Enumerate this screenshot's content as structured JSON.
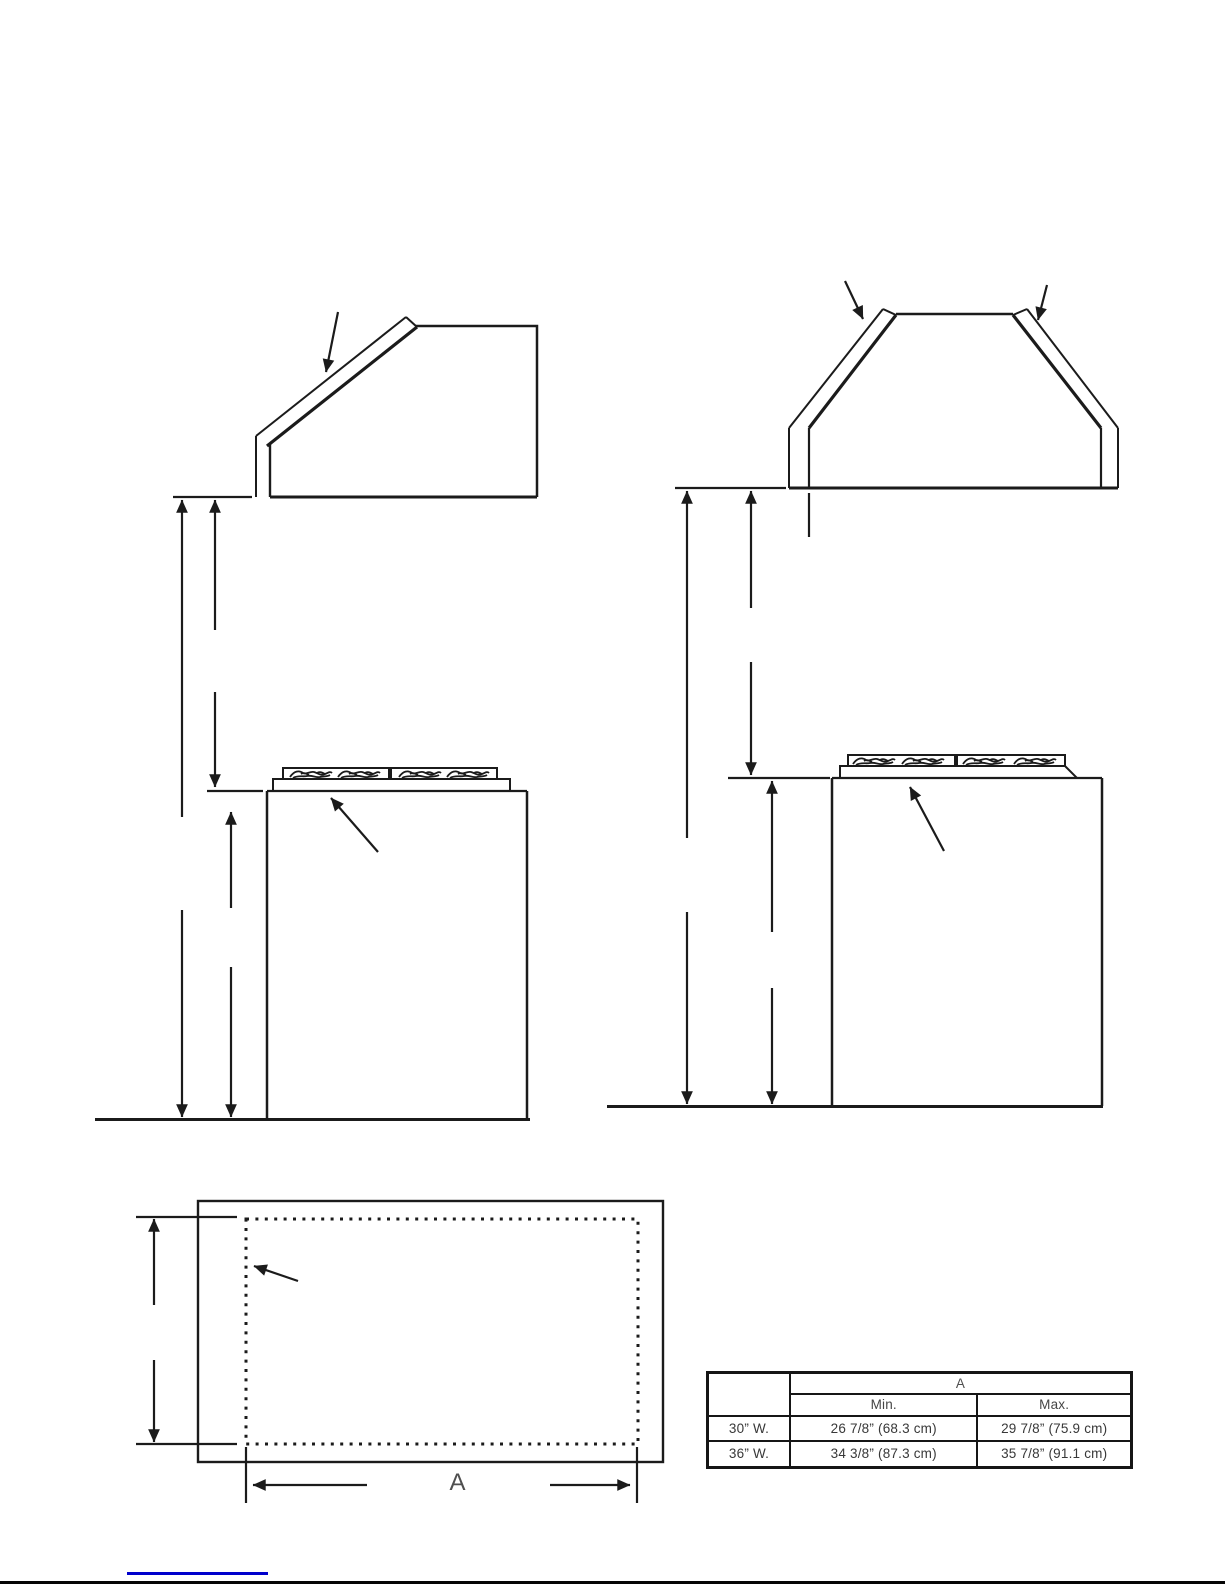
{
  "colors": {
    "ink": "#1b1b1b",
    "table_text": "#383838",
    "header_text": "#4f4f4f",
    "link_blue": "#0000cc"
  },
  "plan_view": {
    "width_label": "A"
  },
  "spec_table": {
    "group_header": "A",
    "sub_headers": [
      "Min.",
      "Max."
    ],
    "rows": [
      {
        "label": "30” W.",
        "min": "26 7/8” (68.3 cm)",
        "max": "29 7/8” (75.9 cm)"
      },
      {
        "label": "36” W.",
        "min": "34 3/8” (87.3 cm)",
        "max": "35 7/8” (91.1 cm)"
      }
    ]
  }
}
